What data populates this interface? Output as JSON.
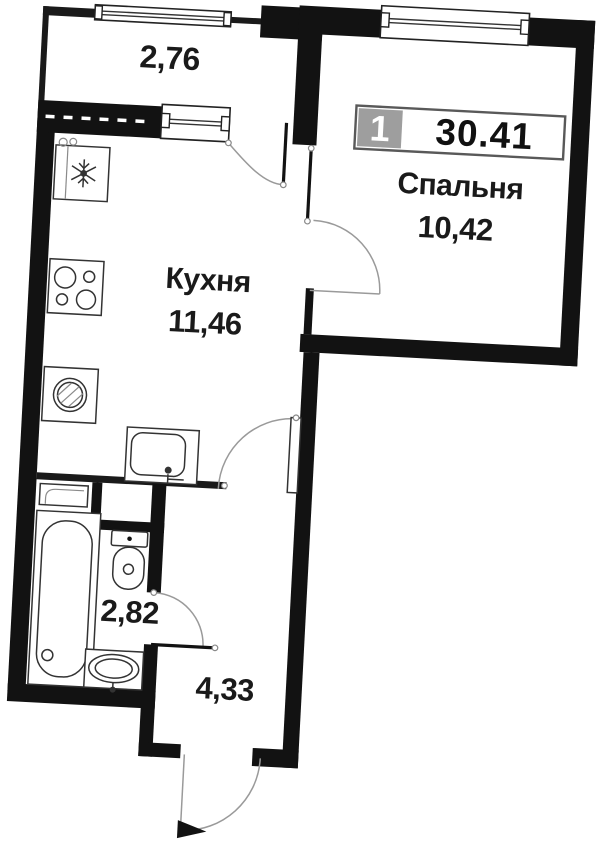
{
  "title": "apartment-floor-plan",
  "badge": {
    "room_count": "1",
    "total_area": "30.41"
  },
  "rooms": {
    "balcony": {
      "area": "2,76"
    },
    "kitchen": {
      "name": "Кухня",
      "area": "11,46"
    },
    "bedroom": {
      "name": "Спальня",
      "area": "10,42"
    },
    "bathroom": {
      "area": "2,82"
    },
    "hallway": {
      "area": "4,33"
    }
  },
  "colors": {
    "wall": "#121212",
    "background": "#ffffff",
    "badge_box": "#9e9e9e",
    "badge_border": "#595959",
    "text": "#1a1a1a",
    "door_arc": "#9a9a9a"
  },
  "icons": {
    "kitchen": [
      "fridge-icon",
      "stove-icon",
      "washing-machine-icon",
      "kitchen-sink-icon"
    ],
    "bathroom": [
      "bathtub-icon",
      "toilet-icon",
      "bathroom-sink-icon",
      "shelf-icon"
    ],
    "openings": [
      "window",
      "door-swing-arc",
      "entrance-door"
    ]
  }
}
